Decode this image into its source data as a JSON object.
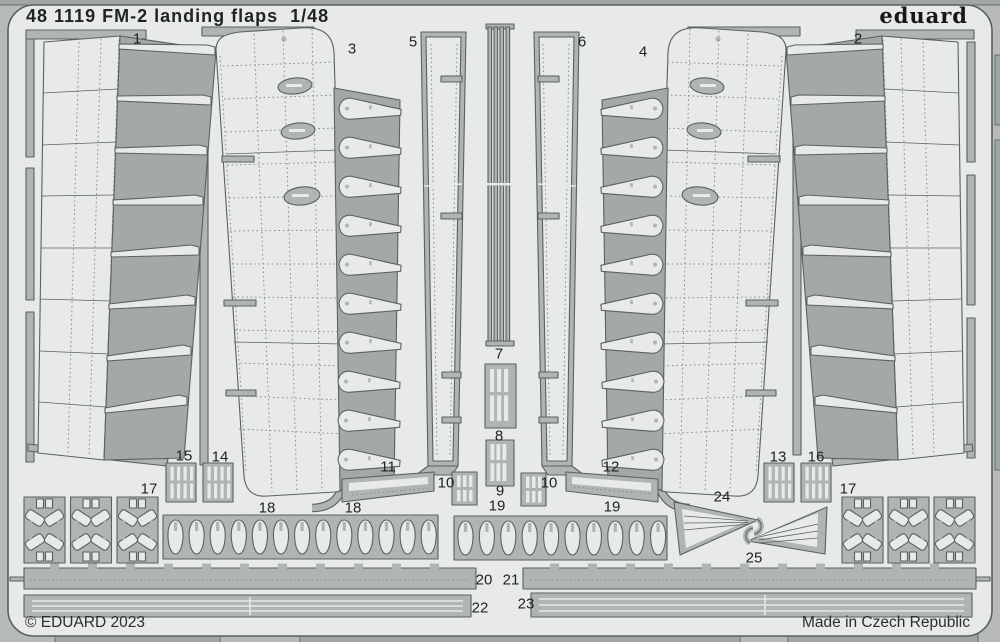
{
  "header": {
    "title": "48 1119 FM-2 landing flaps  1/48",
    "logo": "eduard"
  },
  "footer": {
    "copyright": "© EDUARD 2023",
    "made_in": "Made in Czech Republic"
  },
  "sheet": {
    "scale": "1/48",
    "product_code": "48 1119",
    "subject": "FM-2 landing flaps"
  },
  "colors": {
    "outside": "#b6baba",
    "sheet": "#e8eae9",
    "metal": "#afb5b3",
    "metal2": "#a3a9a8",
    "edge": "#a0a6a5",
    "outline": "#5a615f",
    "rivet": "#878e8c",
    "ink": "#1f2322"
  },
  "part_labels": [
    {
      "id": "1",
      "x": 137,
      "y": 39
    },
    {
      "id": "2",
      "x": 858,
      "y": 39
    },
    {
      "id": "3",
      "x": 352,
      "y": 49
    },
    {
      "id": "4",
      "x": 643,
      "y": 52
    },
    {
      "id": "5",
      "x": 413,
      "y": 42
    },
    {
      "id": "6",
      "x": 582,
      "y": 42
    },
    {
      "id": "7",
      "x": 499,
      "y": 354
    },
    {
      "id": "8",
      "x": 499,
      "y": 436
    },
    {
      "id": "9",
      "x": 500,
      "y": 491
    },
    {
      "id": "10",
      "x": 446,
      "y": 483
    },
    {
      "id": "10",
      "x": 549,
      "y": 483
    },
    {
      "id": "11",
      "x": 388,
      "y": 467
    },
    {
      "id": "12",
      "x": 611,
      "y": 467
    },
    {
      "id": "13",
      "x": 778,
      "y": 457
    },
    {
      "id": "14",
      "x": 220,
      "y": 457
    },
    {
      "id": "15",
      "x": 184,
      "y": 456
    },
    {
      "id": "16",
      "x": 816,
      "y": 457
    },
    {
      "id": "17",
      "x": 149,
      "y": 489
    },
    {
      "id": "17",
      "x": 848,
      "y": 489
    },
    {
      "id": "18",
      "x": 267,
      "y": 508
    },
    {
      "id": "18",
      "x": 353,
      "y": 508
    },
    {
      "id": "19",
      "x": 497,
      "y": 506
    },
    {
      "id": "19",
      "x": 612,
      "y": 507
    },
    {
      "id": "20",
      "x": 484,
      "y": 580
    },
    {
      "id": "21",
      "x": 511,
      "y": 580
    },
    {
      "id": "22",
      "x": 480,
      "y": 608
    },
    {
      "id": "23",
      "x": 526,
      "y": 604
    },
    {
      "id": "24",
      "x": 722,
      "y": 497
    },
    {
      "id": "25",
      "x": 754,
      "y": 558
    }
  ]
}
